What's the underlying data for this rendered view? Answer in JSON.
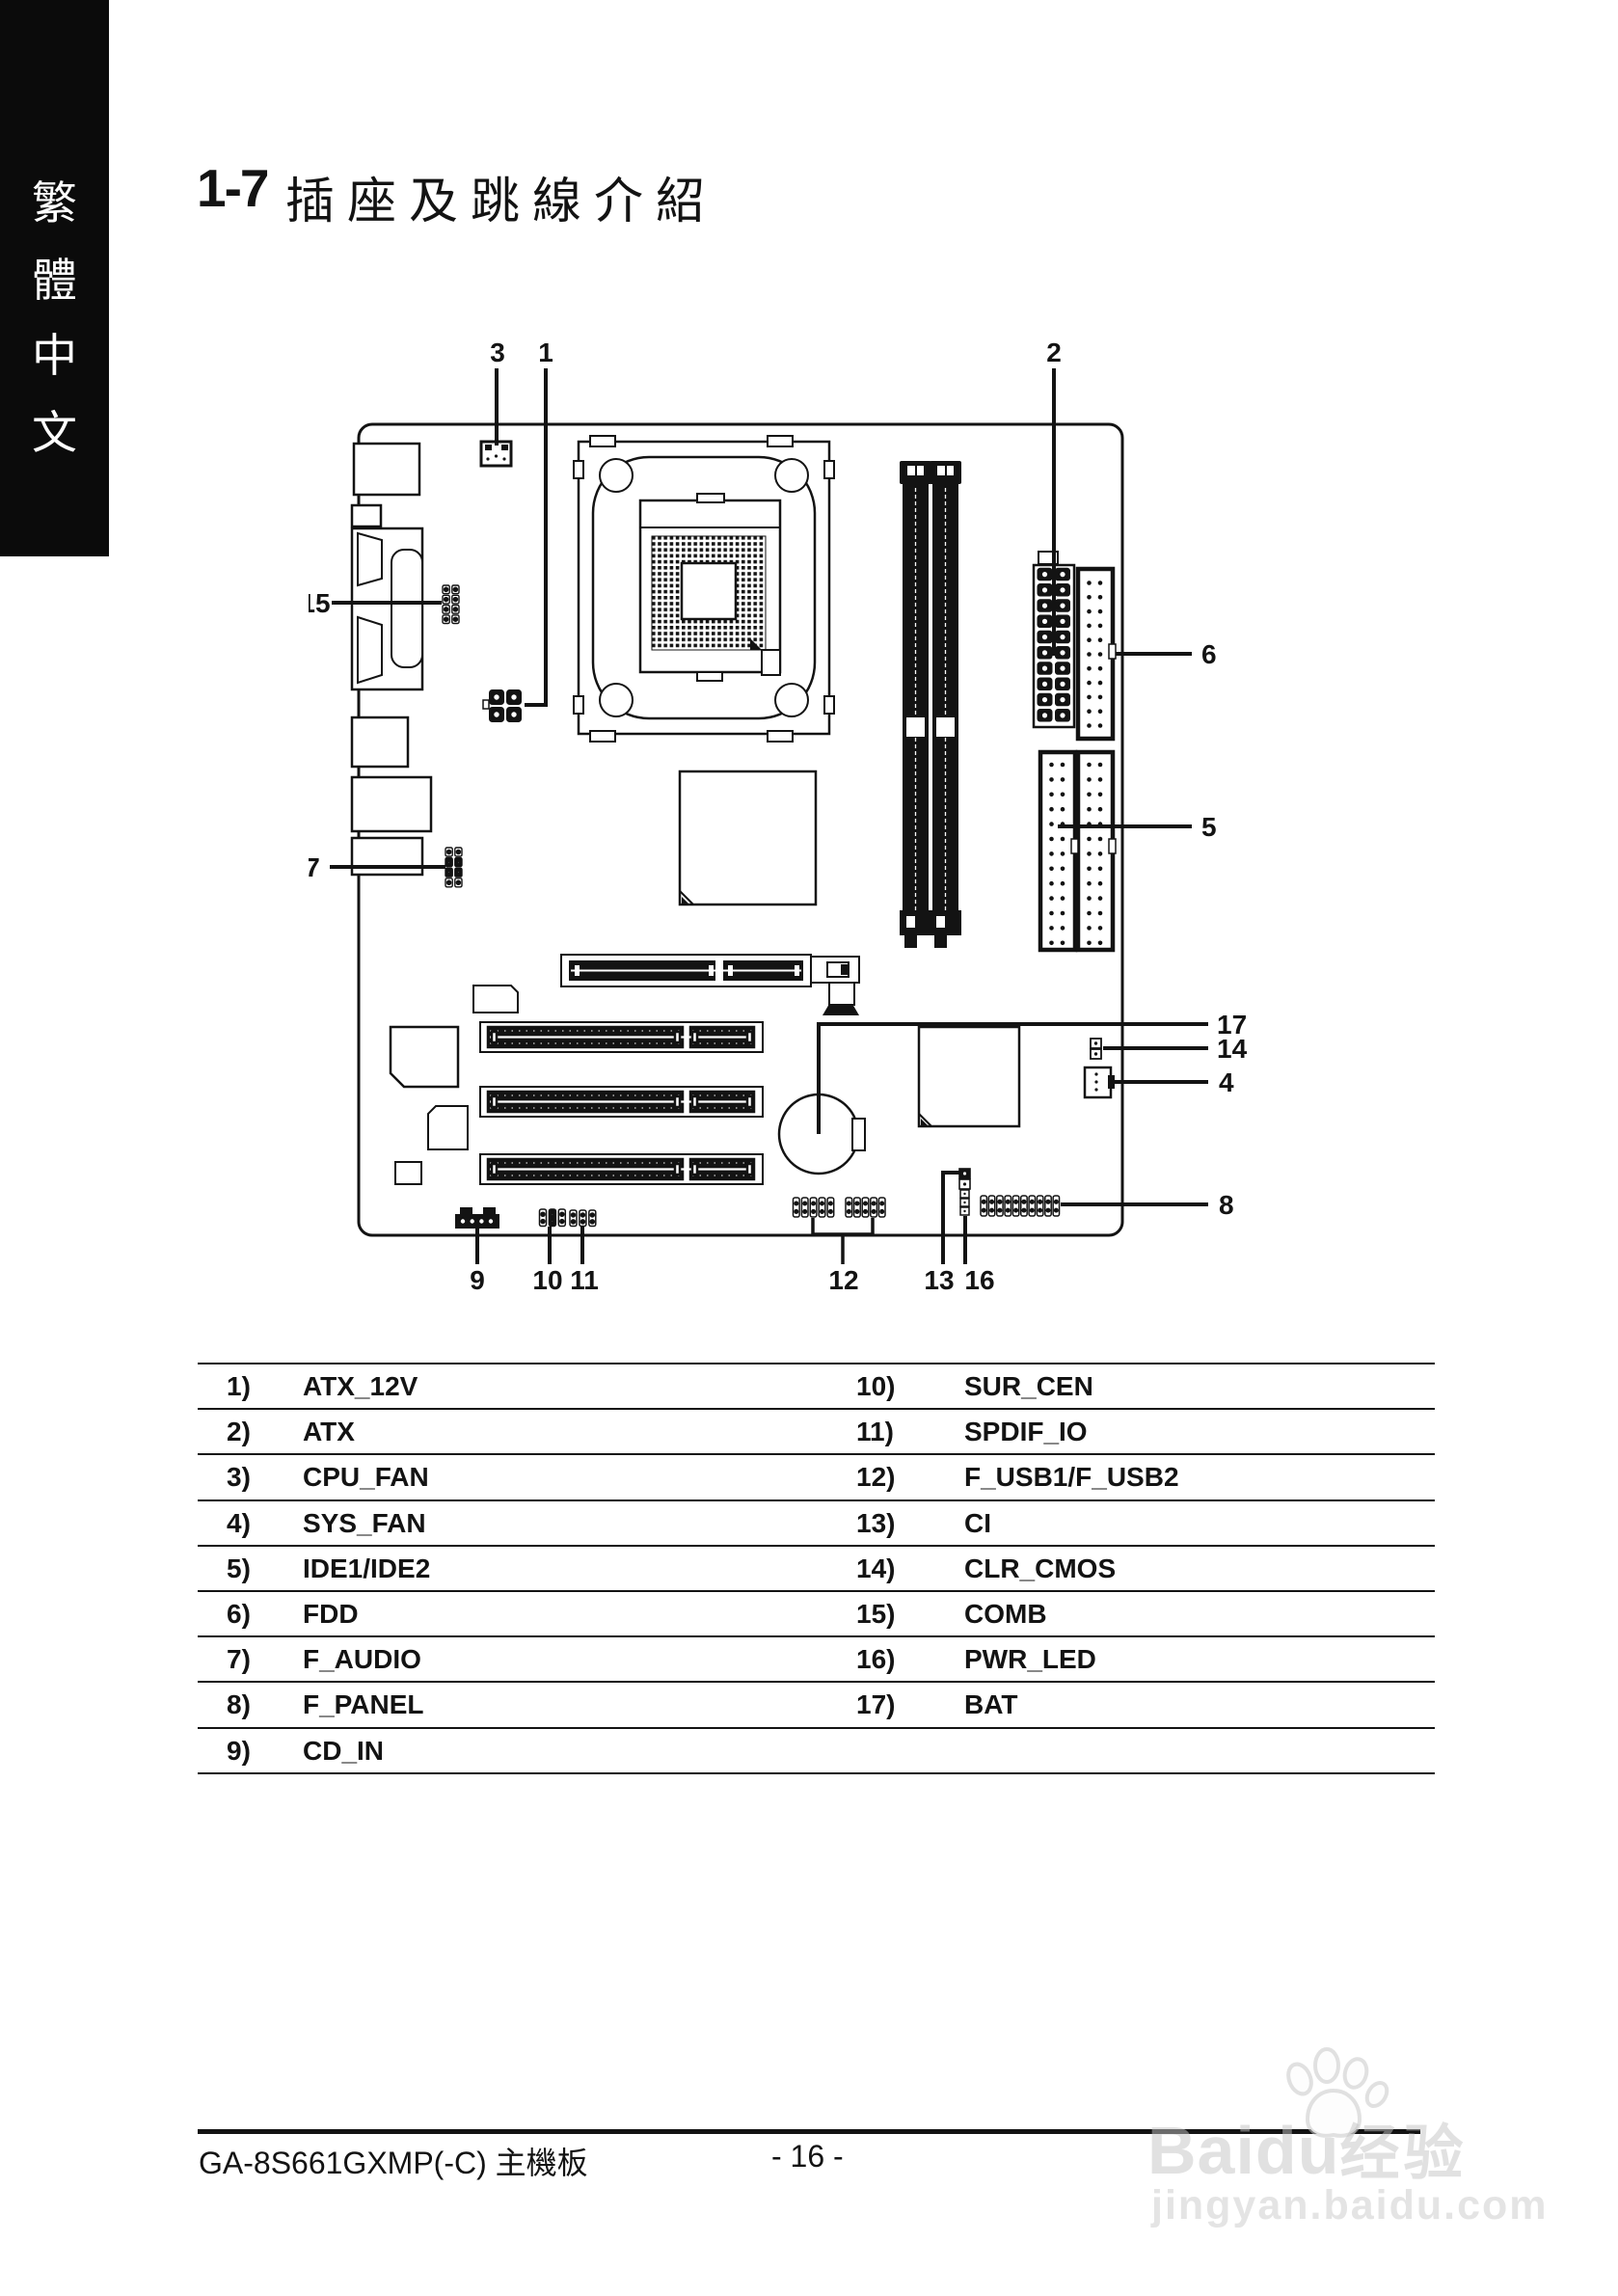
{
  "sidebar": {
    "chars": [
      "繁",
      "體",
      "中",
      "文"
    ]
  },
  "header": {
    "section_no": "1-7",
    "title": "插座及跳線介紹"
  },
  "diagram": {
    "labels": [
      "3",
      "1",
      "2",
      "15",
      "7",
      "6",
      "5",
      "17",
      "14",
      "4",
      "8",
      "9",
      "10",
      "11",
      "12",
      "13",
      "16"
    ]
  },
  "table": {
    "rows": [
      {
        "n1": "1)",
        "v1": "ATX_12V",
        "n2": "10)",
        "v2": "SUR_CEN"
      },
      {
        "n1": "2)",
        "v1": "ATX",
        "n2": "11)",
        "v2": "SPDIF_IO"
      },
      {
        "n1": "3)",
        "v1": "CPU_FAN",
        "n2": "12)",
        "v2": "F_USB1/F_USB2"
      },
      {
        "n1": "4)",
        "v1": "SYS_FAN",
        "n2": "13)",
        "v2": "CI"
      },
      {
        "n1": "5)",
        "v1": "IDE1/IDE2",
        "n2": "14)",
        "v2": "CLR_CMOS"
      },
      {
        "n1": "6)",
        "v1": "FDD",
        "n2": "15)",
        "v2": "COMB"
      },
      {
        "n1": "7)",
        "v1": "F_AUDIO",
        "n2": "16)",
        "v2": "PWR_LED"
      },
      {
        "n1": "8)",
        "v1": "F_PANEL",
        "n2": "17)",
        "v2": "BAT"
      },
      {
        "n1": "9)",
        "v1": "CD_IN",
        "n2": "",
        "v2": ""
      }
    ]
  },
  "footer": {
    "model": "GA-8S661GXMP(-C)",
    "board": "主機板",
    "page_no": "- 16 -"
  },
  "watermark": {
    "brand": "Baidu",
    "brand_cn": "经验",
    "url": "jingyan.baidu.com"
  }
}
